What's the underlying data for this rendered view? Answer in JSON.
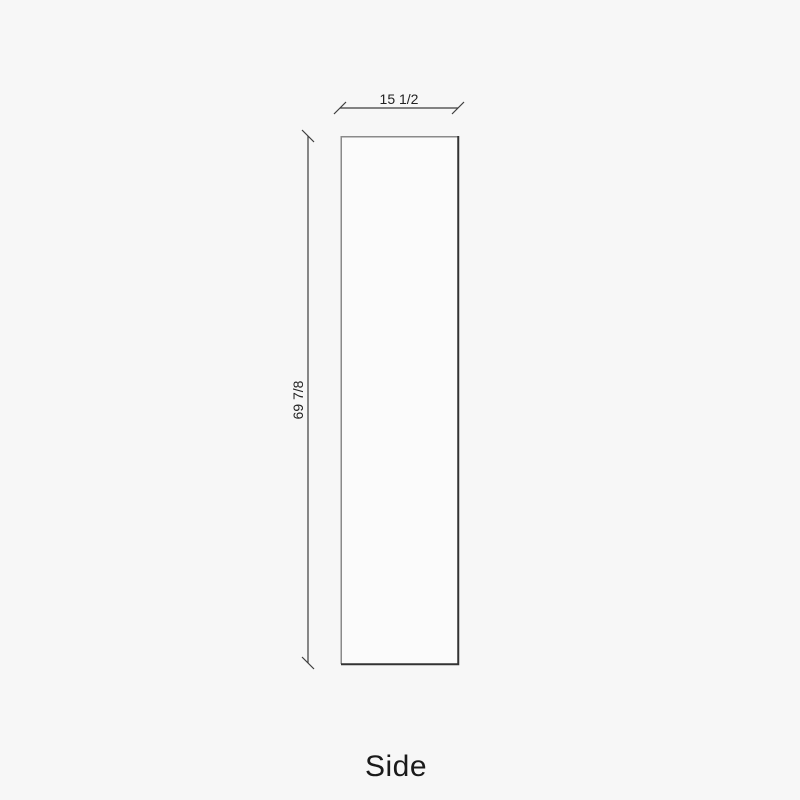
{
  "drawing": {
    "view_title": "Side",
    "width_label": "15 1/2",
    "height_label": "69 7/8"
  },
  "colors": {
    "background": "#f7f7f7",
    "panel_fill": "#fbfbfb",
    "edge_light": "#8a8a8a",
    "edge_dark": "#333333",
    "dimension_line": "#3d3d3d",
    "label_text": "#222222",
    "title_text": "#1a1a1a"
  }
}
